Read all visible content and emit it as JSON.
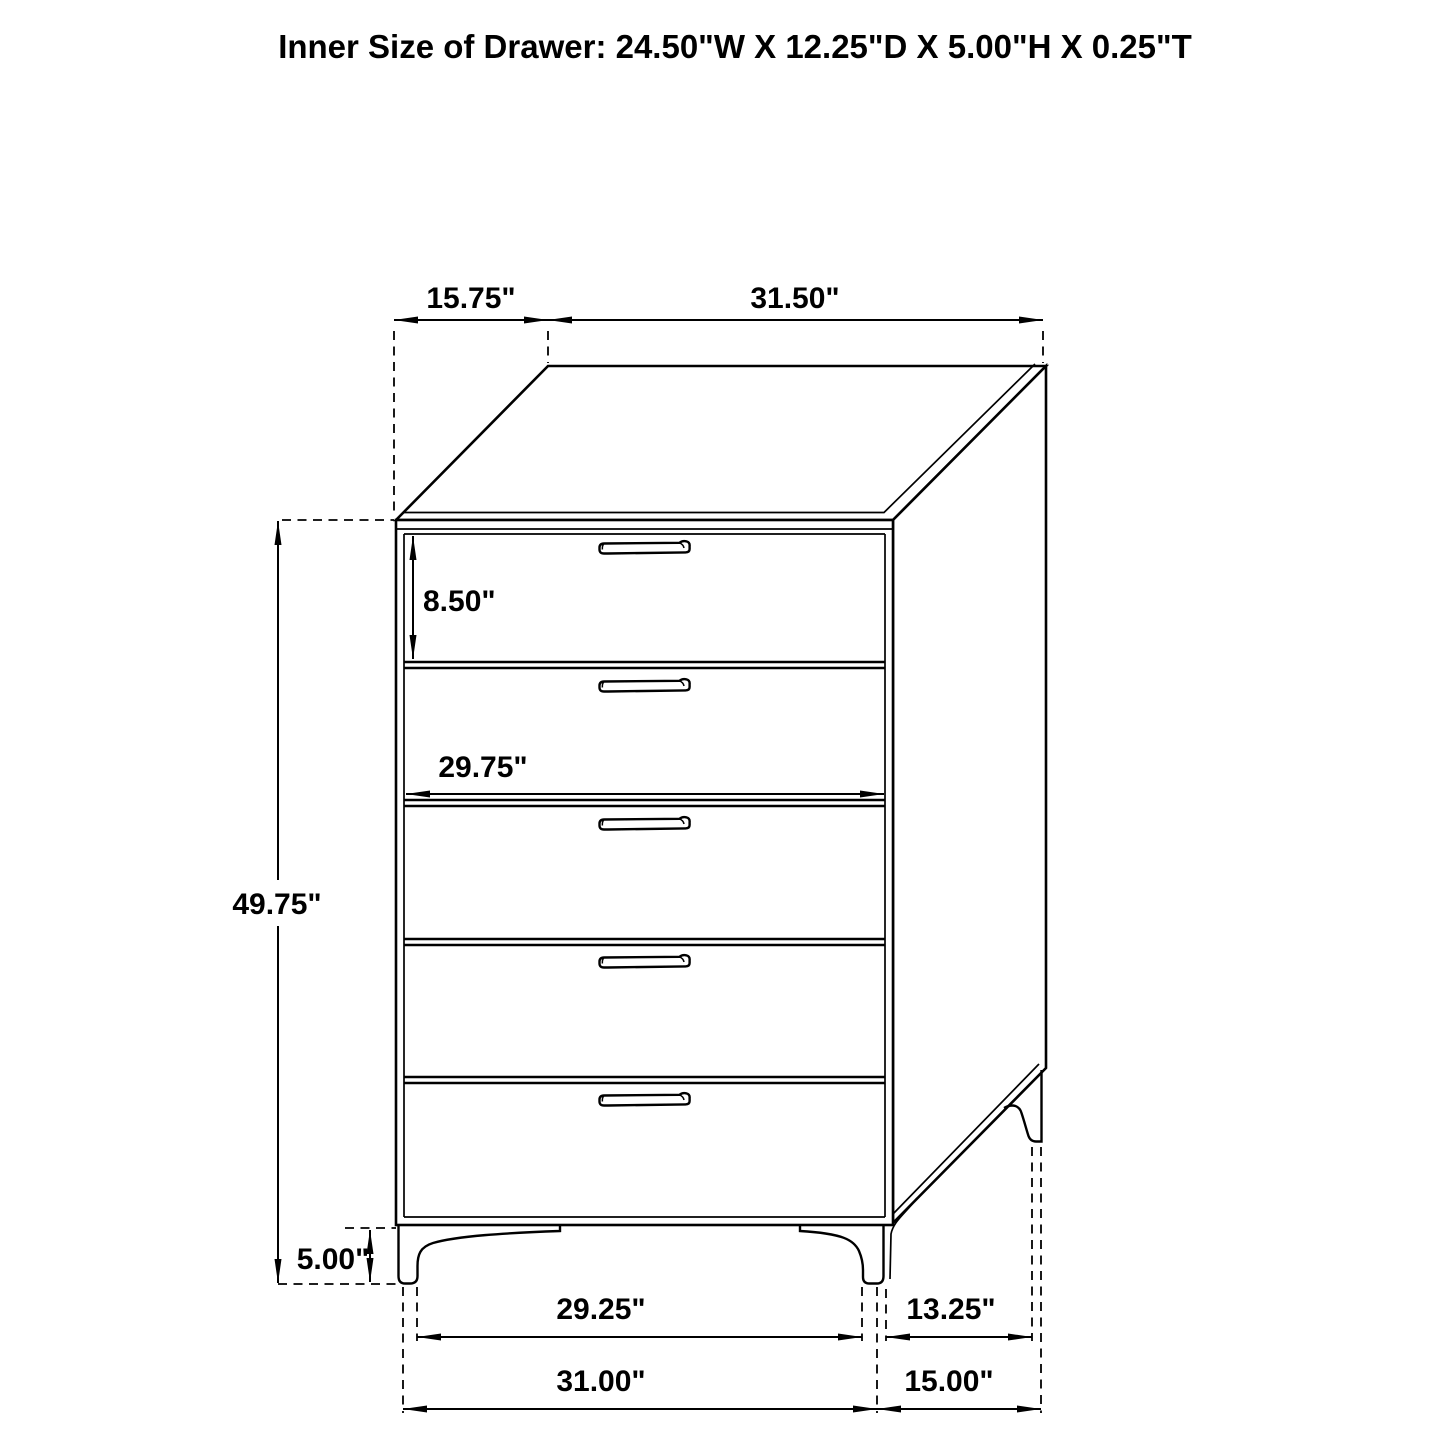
{
  "title": "Inner Size of Drawer: 24.50\"W X 12.25\"D X 5.00\"H X 0.25\"T",
  "cabinet": {
    "drawer_count": 5,
    "style": "line-art technical drawing"
  },
  "colors": {
    "line": "#000000",
    "background": "#ffffff"
  },
  "dimensions": {
    "top_depth": "15.75\"",
    "top_width": "31.50\"",
    "drawer_height": "8.50\"",
    "drawer_inner_width": "29.75\"",
    "overall_height": "49.75\"",
    "leg_height": "5.00\"",
    "front_leg_spacing": "29.25\"",
    "overall_width": "31.00\"",
    "side_leg_spacing": "13.25\"",
    "overall_depth": "15.00\""
  }
}
